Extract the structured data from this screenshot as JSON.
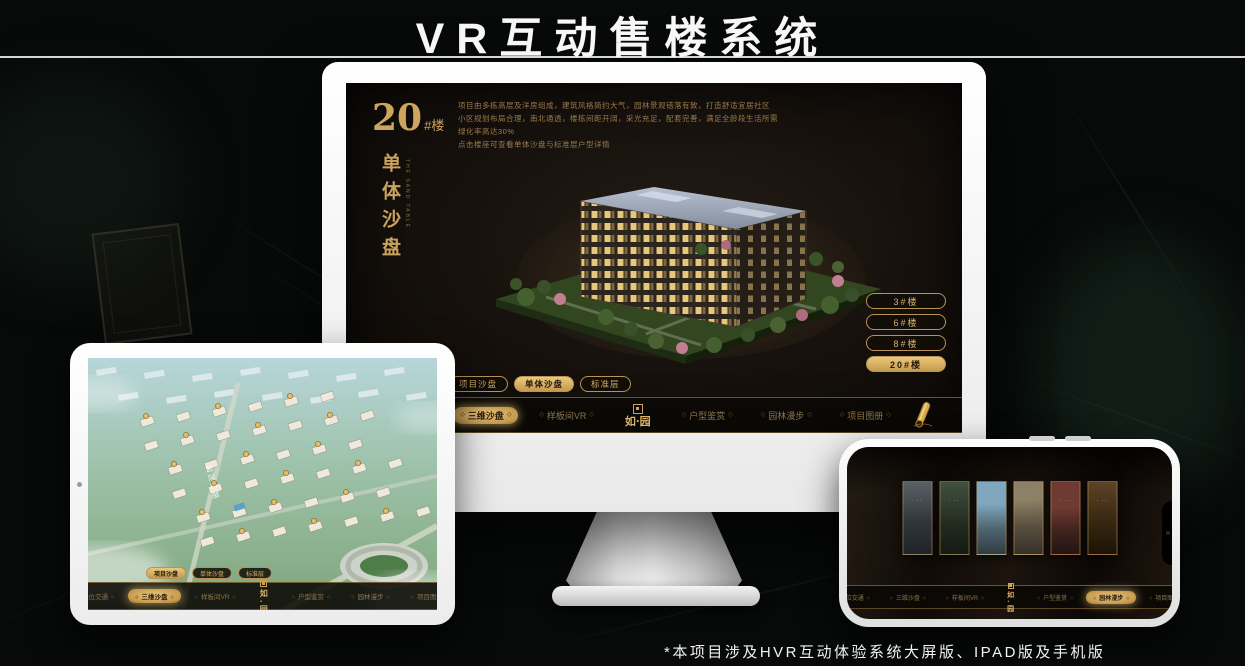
{
  "page": {
    "title": "VR互动售楼系统",
    "footnote": "*本项目涉及HVR互动体验系统大屏版、IPAD版及手机版"
  },
  "app": {
    "logo_text": "如·园",
    "nav_items": [
      {
        "label": "区位交通"
      },
      {
        "label": "三维沙盘"
      },
      {
        "label": "样板间VR"
      },
      {
        "label": "户型鉴赏"
      },
      {
        "label": "园林漫步"
      },
      {
        "label": "项目图册"
      }
    ]
  },
  "monitor": {
    "screen_title": {
      "number": "20",
      "suffix": "#楼"
    },
    "subtitle_vertical": "单体沙盘",
    "subtitle_latin": "THE SAND TABLE",
    "description_lines": [
      "项目由多栋高层及洋房组成，建筑风格简约大气，园林景观错落有致，打造舒适宜居社区",
      "小区规划布局合理，南北通透，楼栋间距开阔，采光充足，配套完善，满足全龄段生活所需",
      "绿化率高达30%",
      "点击楼座可查看单体沙盘与标准层户型详情"
    ],
    "floor_buttons": [
      {
        "label": "3#楼",
        "active": false
      },
      {
        "label": "6#楼",
        "active": false
      },
      {
        "label": "8#楼",
        "active": false
      },
      {
        "label": "20#楼",
        "active": true
      }
    ],
    "tabs": [
      {
        "label": "项目沙盘",
        "active": false
      },
      {
        "label": "单体沙盘",
        "active": true
      },
      {
        "label": "标准层",
        "active": false
      }
    ],
    "active_nav": "三维沙盘"
  },
  "tablet": {
    "tabs": [
      {
        "label": "项目沙盘",
        "active": true
      },
      {
        "label": "单体沙盘",
        "active": false
      },
      {
        "label": "标准层",
        "active": false
      }
    ],
    "active_nav": "三维沙盘",
    "road_label": "园区三路"
  },
  "phone": {
    "active_nav": "园林漫步",
    "panels": [
      {
        "tone": "t1"
      },
      {
        "tone": "t2"
      },
      {
        "tone": "t3"
      },
      {
        "tone": "t4"
      },
      {
        "tone": "t5"
      },
      {
        "tone": "t6"
      }
    ]
  },
  "colors": {
    "gold": "#c9a25e",
    "gold_bright": "#ecc87c",
    "screen_bg": "#15100c",
    "title_white": "#f7f7f7"
  }
}
